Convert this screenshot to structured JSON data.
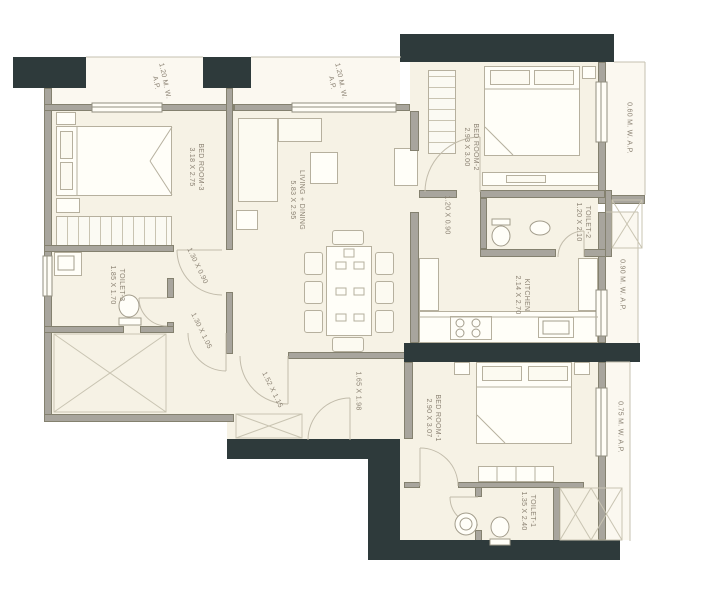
{
  "plan": {
    "rooms": [
      {
        "name": "BED ROOM-3",
        "dims": "3.18 X 2.75"
      },
      {
        "name": "LIVING + DINING",
        "dims": "5.83 X 2.95"
      },
      {
        "name": "BED ROOM-2",
        "dims": "2.93 X 3.00"
      },
      {
        "name": "TOILET-2",
        "dims": "1.20 X 2.10"
      },
      {
        "name": "KITCHEN",
        "dims": "2.14 X 2.70"
      },
      {
        "name": "BED ROOM-1",
        "dims": "2.90 X 3.07"
      },
      {
        "name": "TOILET-1",
        "dims": "1.35 X 2.40"
      },
      {
        "name": "TOILET-3",
        "dims": "1.85 X 1.70"
      }
    ],
    "passages": [
      {
        "dims": "1.30 X 0.90"
      },
      {
        "dims": "1.30 X 1.05"
      },
      {
        "dims": "1.52 X 1.15"
      },
      {
        "dims": "1.65 X 1.98"
      },
      {
        "dims": "1.20 X 0.90"
      }
    ],
    "projections": [
      {
        "line1": "1.20 M. W.",
        "line2": "A.P."
      },
      {
        "line1": "1.20 M. W.",
        "line2": "A.P."
      },
      {
        "line1": "0.60 M. W. A.P."
      },
      {
        "line1": "0.90 M. W. A.P."
      },
      {
        "line1": "0.75 M. W. A.P."
      }
    ],
    "colors": {
      "wall_dark": "#2e3a3b",
      "wall_gray": "#a8a59d",
      "floor": "#f6f2e5",
      "projection_floor": "#fbf8f0",
      "line": "#b6b09e",
      "text": "#8b8273"
    }
  }
}
